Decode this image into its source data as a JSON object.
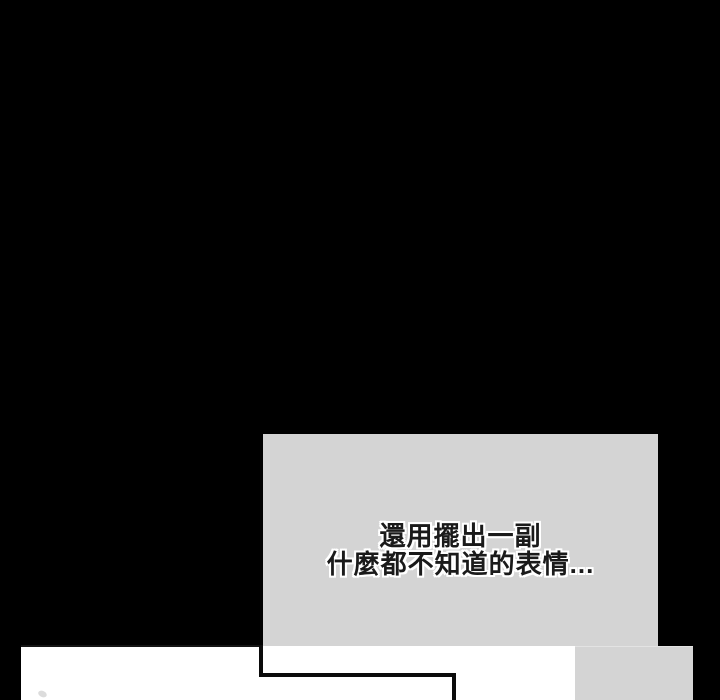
{
  "page": {
    "type": "webtoon-comic-strip-segment",
    "background_color": "#000000"
  },
  "dialog": {
    "panel_color": "#d4d4d4",
    "text_color": "#1a1a1a",
    "outline_color": "#ffffff",
    "lines": [
      "還用擺出一副",
      "什麼都不知道的表情..."
    ]
  },
  "panels": {
    "next_dialog_panel_color": "#d4d4d4",
    "frame_color": "#ffffff",
    "frame_border_color": "#0b0b0b"
  }
}
